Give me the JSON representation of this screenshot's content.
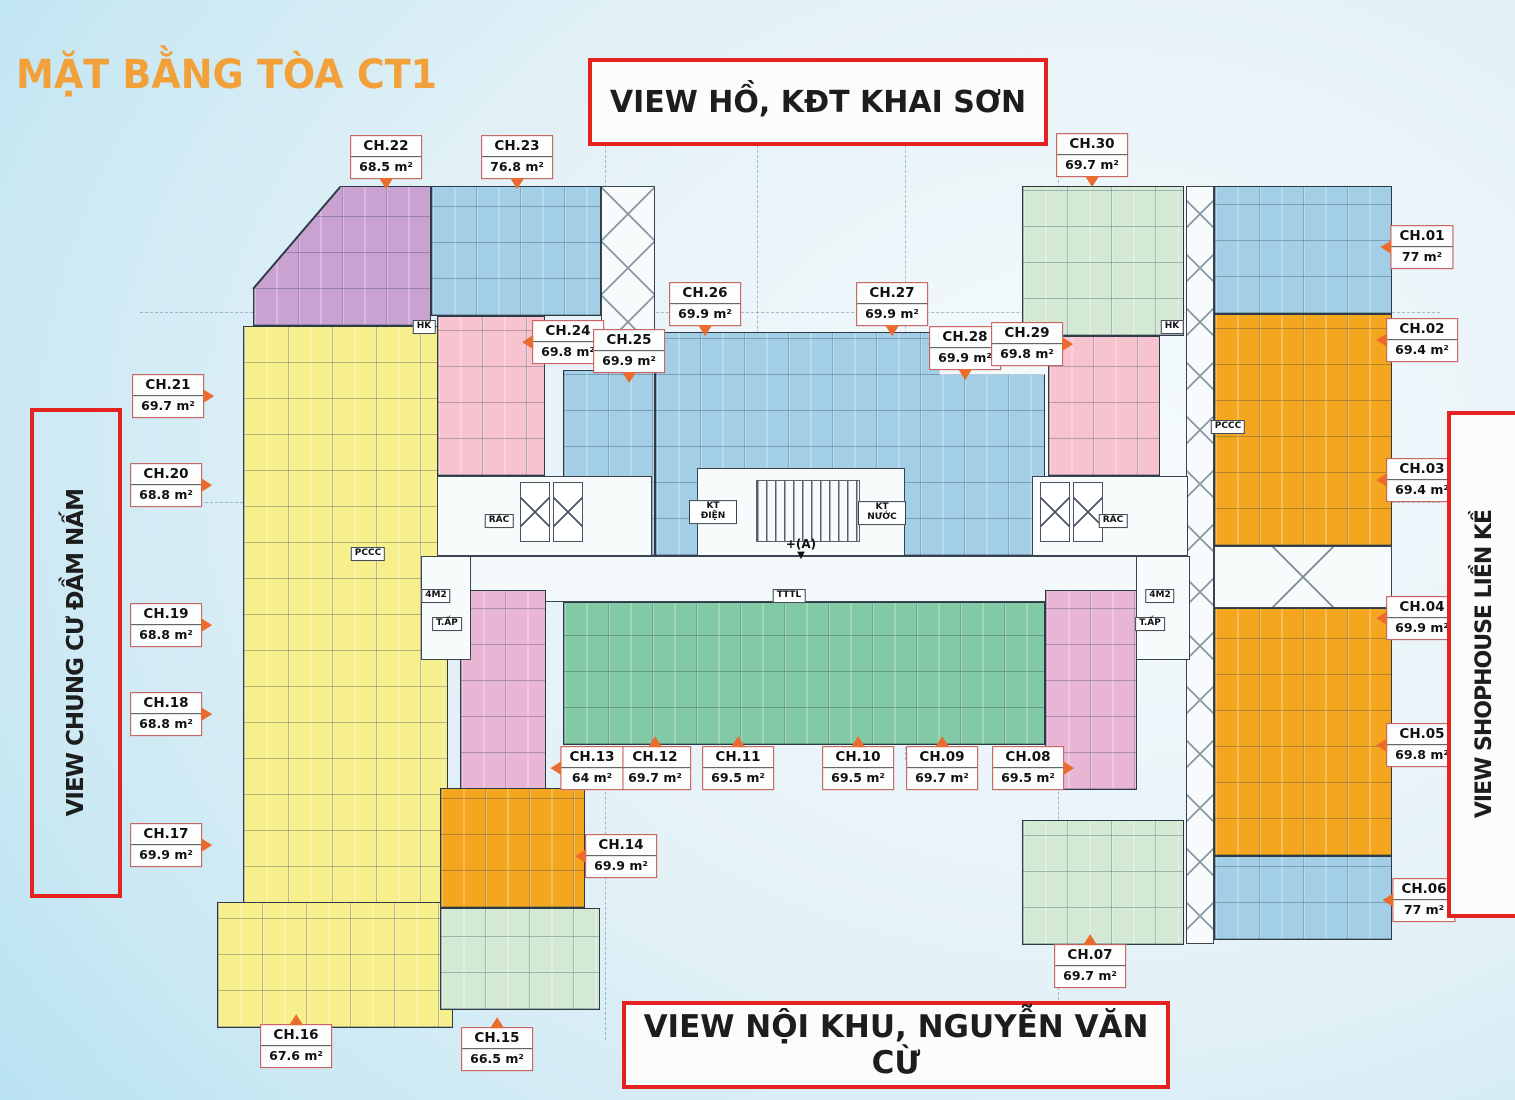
{
  "title": "MẶT BẰNG TÒA CT1",
  "views": {
    "top": "VIEW HỒ, KĐT KHAI SƠN",
    "bottom": "VIEW NỘI KHU, NGUYỄN VĂN CỪ",
    "left": "VIEW CHUNG CƯ ĐẦM NẤM",
    "right": "VIEW SHOPHOUSE LIỀN KỀ"
  },
  "units": [
    {
      "id": "CH.01",
      "area": "77 m²"
    },
    {
      "id": "CH.02",
      "area": "69.4 m²"
    },
    {
      "id": "CH.03",
      "area": "69.4 m²"
    },
    {
      "id": "CH.04",
      "area": "69.9 m²"
    },
    {
      "id": "CH.05",
      "area": "69.8 m²"
    },
    {
      "id": "CH.06",
      "area": "77 m²"
    },
    {
      "id": "CH.07",
      "area": "69.7 m²"
    },
    {
      "id": "CH.08",
      "area": "69.5 m²"
    },
    {
      "id": "CH.09",
      "area": "69.7 m²"
    },
    {
      "id": "CH.10",
      "area": "69.5 m²"
    },
    {
      "id": "CH.11",
      "area": "69.5 m²"
    },
    {
      "id": "CH.12",
      "area": "69.7 m²"
    },
    {
      "id": "CH.13",
      "area": "64 m²"
    },
    {
      "id": "CH.14",
      "area": "69.9 m²"
    },
    {
      "id": "CH.15",
      "area": "66.5 m²"
    },
    {
      "id": "CH.16",
      "area": "67.6 m²"
    },
    {
      "id": "CH.17",
      "area": "69.9 m²"
    },
    {
      "id": "CH.18",
      "area": "68.8 m²"
    },
    {
      "id": "CH.19",
      "area": "68.8 m²"
    },
    {
      "id": "CH.20",
      "area": "68.8 m²"
    },
    {
      "id": "CH.21",
      "area": "69.7 m²"
    },
    {
      "id": "CH.22",
      "area": "68.5 m²"
    },
    {
      "id": "CH.23",
      "area": "76.8 m²"
    },
    {
      "id": "CH.24",
      "area": "69.8 m²"
    },
    {
      "id": "CH.25",
      "area": "69.9 m²"
    },
    {
      "id": "CH.26",
      "area": "69.9 m²"
    },
    {
      "id": "CH.27",
      "area": "69.9 m²"
    },
    {
      "id": "CH.28",
      "area": "69.9 m²"
    },
    {
      "id": "CH.29",
      "area": "69.8 m²"
    },
    {
      "id": "CH.30",
      "area": "69.7 m²"
    }
  ],
  "plan_labels": [
    {
      "id": "kt-dien",
      "text": "KT ĐIỆN"
    },
    {
      "id": "kt-nuoc",
      "text": "KT NƯỚC"
    },
    {
      "id": "rac-left",
      "text": "RÁC"
    },
    {
      "id": "rac-right",
      "text": "RÁC"
    },
    {
      "id": "pccc-left",
      "text": "PCCC"
    },
    {
      "id": "pccc-right",
      "text": "PCCC"
    },
    {
      "id": "hk-left",
      "text": "HK"
    },
    {
      "id": "hk-right",
      "text": "HK"
    },
    {
      "id": "m4-left",
      "text": "4M2"
    },
    {
      "id": "m4-right",
      "text": "4M2"
    },
    {
      "id": "tap-left",
      "text": "T.ẤP"
    },
    {
      "id": "tap-right",
      "text": "T.ẤP"
    },
    {
      "id": "tttl",
      "text": "TTTL"
    },
    {
      "id": "axis-a",
      "text": "+(A)"
    }
  ],
  "colors": {
    "accent_orange": "#F2A13A",
    "border_red": "#E42320",
    "arrow_orange": "#EB6A2E",
    "text_dark": "#1D1D1D",
    "block_blue": "#A2CEE6",
    "block_yellow": "#F6EF8C",
    "block_purple": "#C9A2D2",
    "block_pink": "#F7C3CF",
    "block_mauve": "#E9B5D4",
    "block_green": "#82C9A5",
    "block_lightgreen": "#D4E9D3",
    "block_orange": "#F4A71E"
  }
}
